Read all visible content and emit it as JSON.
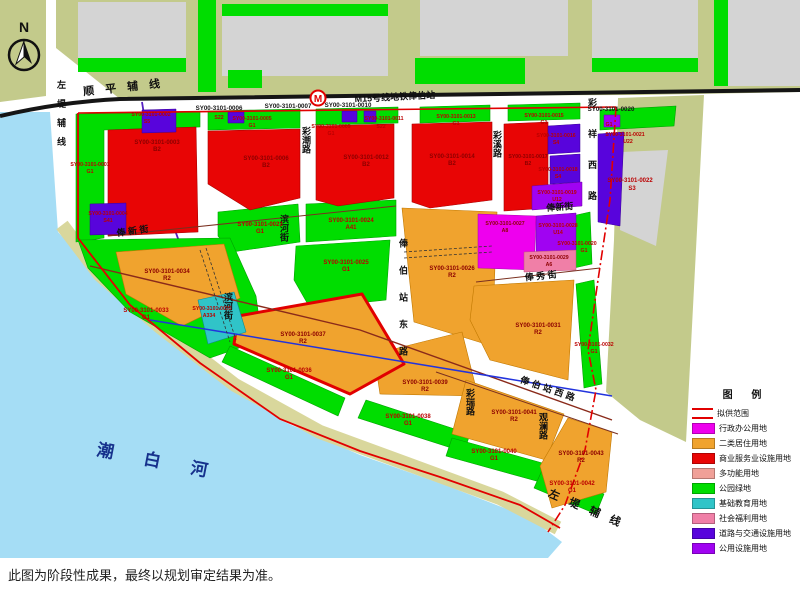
{
  "map": {
    "caption": "此图为阶段性成果，最终以规划审定结果为准。",
    "compass_label": "N",
    "metro": {
      "logo": "M",
      "station_label": "M15号线地铁俸伯站"
    },
    "river_label": "潮 白 河",
    "roads": {
      "shunping": "顺 平 辅 线",
      "zuodi_left": "左堤辅线",
      "zuodi_bottom": "左 堤 辅 线",
      "caichao": "彩潮路",
      "caixi": "彩溪路",
      "caixiang_west": "彩祥西路",
      "fengxin_1": "俸 新 街",
      "fengxin_2": "俸新街",
      "fengxiu": "俸 秀 街",
      "fengbo_east": "俸伯站东路",
      "fengbo_west": "俸伯站西路",
      "cairui": "彩瑞路",
      "guanlan": "观澜路",
      "binhe_1": "滨河街",
      "binhe_2": "滨河街"
    },
    "top_labels": {
      "t0006": "SY00-3101-0006",
      "t0007": "SY00-3101-0007",
      "t0010": "SY00-3101-0010"
    },
    "extra": {
      "s22_a": "S22"
    },
    "parcels": [
      {
        "code": "SY00-3101-0001",
        "type": "G1"
      },
      {
        "code": "SY00-3101-0002",
        "type": "S5"
      },
      {
        "code": "SY00-3101-0003",
        "type": "B2"
      },
      {
        "code": "SY00-3101-0004",
        "type": "S41"
      },
      {
        "code": "SY00-3101-0005",
        "type": "G1"
      },
      {
        "code": "SY00-3101-0006",
        "type": "B2"
      },
      {
        "code": "SY00-3101-0009",
        "type": "G1"
      },
      {
        "code": "SY00-3101-0011",
        "type": "S22"
      },
      {
        "code": "SY00-3101-0012",
        "type": "B2"
      },
      {
        "code": "SY00-3101-0013",
        "type": "G1"
      },
      {
        "code": "SY00-3101-0014",
        "type": "B2"
      },
      {
        "code": "SY00-3101-0015",
        "type": "G1"
      },
      {
        "code": "SY00-3101-0016",
        "type": "S4"
      },
      {
        "code": "SY00-3101-0017",
        "type": "B2"
      },
      {
        "code": "SY00-3101-0018",
        "type": "S4"
      },
      {
        "code": "SY00-3101-0019",
        "type": "U12"
      },
      {
        "code": "SY00-3101-0020",
        "type": "G1"
      },
      {
        "code": "SY00-3101-0021",
        "type": "U22"
      },
      {
        "code": "SY00-3101-0022",
        "type": "S3"
      },
      {
        "code": "SY00-3101-0020",
        "type": "G1"
      },
      {
        "code": "SY00-3101-0023",
        "type": "G1"
      },
      {
        "code": "SY00-3101-0024",
        "type": "A41"
      },
      {
        "code": "SY00-3101-0025",
        "type": "G1"
      },
      {
        "code": "SY00-3101-0026",
        "type": "R2"
      },
      {
        "code": "SY00-3101-0027",
        "type": "A8"
      },
      {
        "code": "SY00-3101-0028",
        "type": "U14"
      },
      {
        "code": "SY00-3101-0029",
        "type": "A6"
      },
      {
        "code": "SY00-3101-0031",
        "type": "R2"
      },
      {
        "code": "SY00-3101-0032",
        "type": "G1"
      },
      {
        "code": "SY00-3101-0033",
        "type": "G1"
      },
      {
        "code": "SY00-3101-0034",
        "type": "R2"
      },
      {
        "code": "SY00-3101-0035",
        "type": "A334"
      },
      {
        "code": "SY00-3101-0036",
        "type": "G1"
      },
      {
        "code": "SY00-3101-0037",
        "type": "R2"
      },
      {
        "code": "SY00-3101-0038",
        "type": "G1"
      },
      {
        "code": "SY00-3101-0039",
        "type": "R2"
      },
      {
        "code": "SY00-3101-0040",
        "type": "G1"
      },
      {
        "code": "SY00-3101-0041",
        "type": "R2"
      },
      {
        "code": "SY00-3101-0042",
        "type": "G1"
      },
      {
        "code": "SY00-3101-0043",
        "type": "R2"
      }
    ]
  },
  "legend": {
    "title": "图  例",
    "items": [
      {
        "label": "拟供范围",
        "color": "#e10000",
        "symbol": "line"
      },
      {
        "label": "行政办公用地",
        "color": "#ee00ee",
        "symbol": "fill"
      },
      {
        "label": "二类居住用地",
        "color": "#f0a32e",
        "symbol": "fill"
      },
      {
        "label": "商业服务业设施用地",
        "color": "#e80505",
        "symbol": "fill"
      },
      {
        "label": "多功能用地",
        "color": "#f0a098",
        "symbol": "fill"
      },
      {
        "label": "公园绿地",
        "color": "#00dd00",
        "symbol": "fill"
      },
      {
        "label": "基础教育用地",
        "color": "#30c4c8",
        "symbol": "fill"
      },
      {
        "label": "社会福利用地",
        "color": "#f07fa7",
        "symbol": "fill"
      },
      {
        "label": "道路与交通设施用地",
        "color": "#5804dc",
        "symbol": "fill"
      },
      {
        "label": "公用设施用地",
        "color": "#a003f2",
        "symbol": "fill"
      }
    ]
  },
  "colors": {
    "water": "#a5ddf5",
    "levee": "#d9d79c",
    "olive": "#c3ca8b",
    "buildings": "#d4d4d4",
    "park_green": "#00dd00",
    "commercial_red": "#e80505",
    "residential_orange": "#f0a32e",
    "admin_magenta": "#ee00ee",
    "welfare_pink": "#f07fa7",
    "education_teal": "#30c4c8",
    "transport_indigo": "#5804dc",
    "utility_violet": "#a003f2",
    "boundary_red": "#e10000"
  }
}
